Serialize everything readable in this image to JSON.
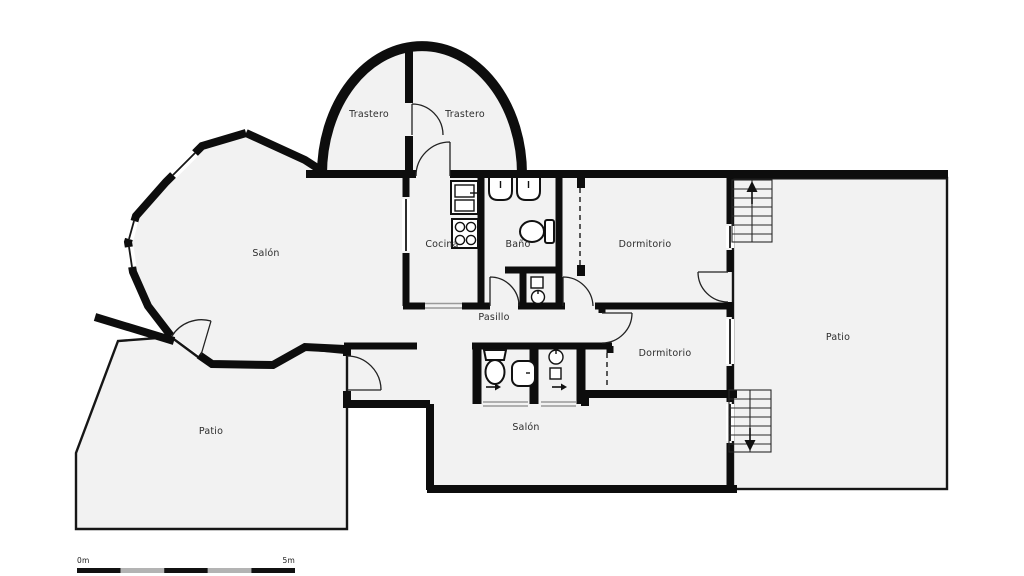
{
  "plan": {
    "rooms": {
      "trastero_left": {
        "label": "Trastero"
      },
      "trastero_right": {
        "label": "Trastero"
      },
      "salon": {
        "label": "Salón"
      },
      "cocina": {
        "label": "Cocina"
      },
      "bano": {
        "label": "Baño"
      },
      "dormitorio_top": {
        "label": "Dormitorio"
      },
      "pasillo": {
        "label": "Pasillo"
      },
      "dormitorio_right": {
        "label": "Dormitorio"
      },
      "patio_right": {
        "label": "Patio"
      },
      "patio_left": {
        "label": "Patio"
      },
      "salon_bottom": {
        "label": "Salón"
      }
    },
    "scale_bar": {
      "start_label": "0m",
      "end_label": "5m"
    },
    "colors": {
      "wall": "#0d0d0d",
      "floor_fill": "#f2f2f2",
      "patio_fill": "#f2f2f2",
      "label_text": "#2d2d2d",
      "scale_dark": "#111111",
      "scale_light": "#b3b3b3"
    }
  }
}
